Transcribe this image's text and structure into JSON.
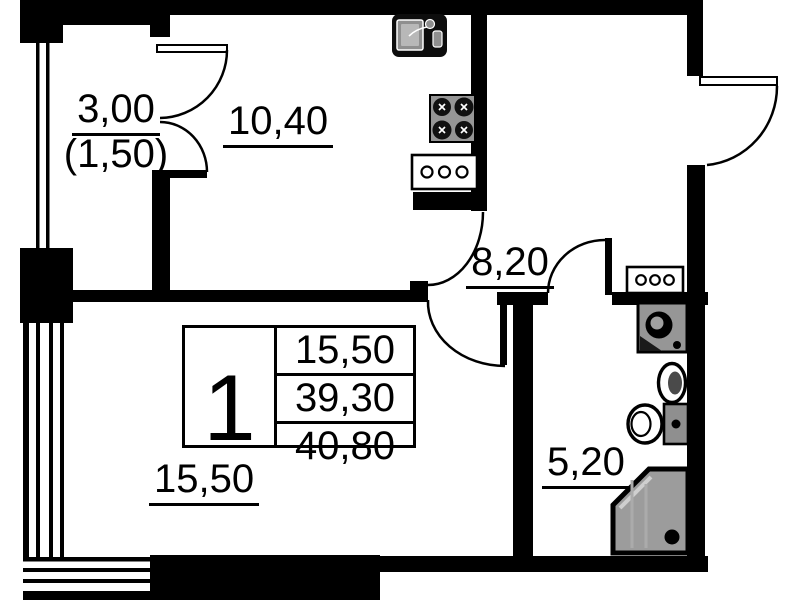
{
  "rooms": {
    "balcony": {
      "area": "3,00",
      "area_reduced": "(1,50)"
    },
    "kitchen": {
      "area": "10,40"
    },
    "hallway": {
      "area": "8,20"
    },
    "living_room": {
      "area": "15,50"
    },
    "bathroom": {
      "area": "5,20"
    }
  },
  "stamp": {
    "flat_number": "1",
    "areas": [
      "15,50",
      "39,30",
      "40,80"
    ]
  },
  "fixtures": [
    "kitchen-sink",
    "stove",
    "kitchen-cabinet",
    "hallway-cabinet",
    "washing-machine",
    "washbasin",
    "toilet",
    "shower"
  ],
  "colors": {
    "walls": "#000000",
    "appliance_gray": "#969696",
    "background": "#ffffff"
  }
}
